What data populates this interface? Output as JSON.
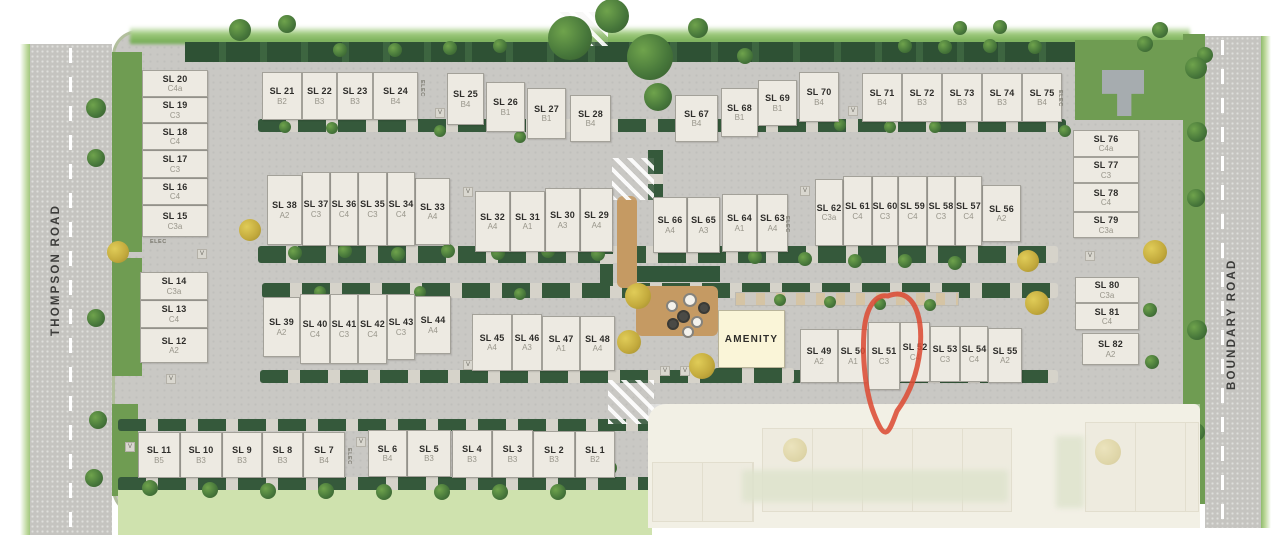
{
  "meta": {
    "description": "Residential strata site plan, 82 lots, amenity building, lot SL 51 circled in red"
  },
  "roads": {
    "left_label": "THOMPSON ROAD",
    "right_label": "BOUNDARY ROAD"
  },
  "amenity": {
    "label": "AMENITY"
  },
  "highlight": {
    "lot": "SL 51",
    "color": "#dc4c35"
  },
  "markers": {
    "visitor_label": "V",
    "elec_label": "ELEC"
  },
  "colors": {
    "lot_fill": "#edeae2",
    "road": "#c6c5c1",
    "hedge": "#31563a",
    "lawn": "#6f9c52",
    "amenity_fill": "#faf5d8",
    "annotation_red": "#dc4c35",
    "sand": "#c59a63"
  },
  "lots": [
    {
      "id": "SL 1",
      "code": "B2",
      "x": 575,
      "y": 431,
      "w": 40,
      "h": 47
    },
    {
      "id": "SL 2",
      "code": "B3",
      "x": 533,
      "y": 431,
      "w": 42,
      "h": 47
    },
    {
      "id": "SL 3",
      "code": "B3",
      "x": 492,
      "y": 430,
      "w": 41,
      "h": 48
    },
    {
      "id": "SL 4",
      "code": "B3",
      "x": 452,
      "y": 430,
      "w": 40,
      "h": 48
    },
    {
      "id": "SL 5",
      "code": "B3",
      "x": 407,
      "y": 430,
      "w": 44,
      "h": 47
    },
    {
      "id": "SL 6",
      "code": "B4",
      "x": 368,
      "y": 430,
      "w": 39,
      "h": 47
    },
    {
      "id": "SL 7",
      "code": "B4",
      "x": 303,
      "y": 432,
      "w": 42,
      "h": 46
    },
    {
      "id": "SL 8",
      "code": "B3",
      "x": 262,
      "y": 432,
      "w": 41,
      "h": 46
    },
    {
      "id": "SL 9",
      "code": "B3",
      "x": 222,
      "y": 432,
      "w": 40,
      "h": 46
    },
    {
      "id": "SL 10",
      "code": "B3",
      "x": 180,
      "y": 432,
      "w": 42,
      "h": 46
    },
    {
      "id": "SL 11",
      "code": "B5",
      "x": 138,
      "y": 432,
      "w": 42,
      "h": 46
    },
    {
      "id": "SL 12",
      "code": "A2",
      "x": 140,
      "y": 328,
      "w": 68,
      "h": 35
    },
    {
      "id": "SL 13",
      "code": "C4",
      "x": 140,
      "y": 300,
      "w": 68,
      "h": 28
    },
    {
      "id": "SL 14",
      "code": "C3a",
      "x": 140,
      "y": 272,
      "w": 68,
      "h": 28
    },
    {
      "id": "SL 15",
      "code": "C3a",
      "x": 142,
      "y": 205,
      "w": 66,
      "h": 32
    },
    {
      "id": "SL 16",
      "code": "C4",
      "x": 142,
      "y": 178,
      "w": 66,
      "h": 27
    },
    {
      "id": "SL 17",
      "code": "C3",
      "x": 142,
      "y": 150,
      "w": 66,
      "h": 28
    },
    {
      "id": "SL 18",
      "code": "C4",
      "x": 142,
      "y": 123,
      "w": 66,
      "h": 27
    },
    {
      "id": "SL 19",
      "code": "C3",
      "x": 142,
      "y": 97,
      "w": 66,
      "h": 26
    },
    {
      "id": "SL 20",
      "code": "C4a",
      "x": 142,
      "y": 70,
      "w": 66,
      "h": 27
    },
    {
      "id": "SL 21",
      "code": "B2",
      "x": 262,
      "y": 72,
      "w": 40,
      "h": 48
    },
    {
      "id": "SL 22",
      "code": "B3",
      "x": 302,
      "y": 72,
      "w": 35,
      "h": 48
    },
    {
      "id": "SL 23",
      "code": "B3",
      "x": 337,
      "y": 72,
      "w": 36,
      "h": 48
    },
    {
      "id": "SL 24",
      "code": "B4",
      "x": 373,
      "y": 72,
      "w": 45,
      "h": 48
    },
    {
      "id": "SL 25",
      "code": "B4",
      "x": 447,
      "y": 73,
      "w": 37,
      "h": 52
    },
    {
      "id": "SL 26",
      "code": "B1",
      "x": 486,
      "y": 82,
      "w": 39,
      "h": 50
    },
    {
      "id": "SL 27",
      "code": "B1",
      "x": 527,
      "y": 88,
      "w": 39,
      "h": 51
    },
    {
      "id": "SL 28",
      "code": "B4",
      "x": 570,
      "y": 95,
      "w": 41,
      "h": 47
    },
    {
      "id": "SL 29",
      "code": "A4",
      "x": 580,
      "y": 188,
      "w": 33,
      "h": 64
    },
    {
      "id": "SL 30",
      "code": "A3",
      "x": 545,
      "y": 188,
      "w": 35,
      "h": 64
    },
    {
      "id": "SL 31",
      "code": "A1",
      "x": 510,
      "y": 191,
      "w": 35,
      "h": 61
    },
    {
      "id": "SL 32",
      "code": "A4",
      "x": 475,
      "y": 191,
      "w": 35,
      "h": 61
    },
    {
      "id": "SL 33",
      "code": "A4",
      "x": 415,
      "y": 178,
      "w": 35,
      "h": 67
    },
    {
      "id": "SL 34",
      "code": "C4",
      "x": 387,
      "y": 172,
      "w": 28,
      "h": 74
    },
    {
      "id": "SL 35",
      "code": "C3",
      "x": 358,
      "y": 172,
      "w": 29,
      "h": 74
    },
    {
      "id": "SL 36",
      "code": "C4",
      "x": 330,
      "y": 172,
      "w": 28,
      "h": 74
    },
    {
      "id": "SL 37",
      "code": "C3",
      "x": 302,
      "y": 172,
      "w": 28,
      "h": 74
    },
    {
      "id": "SL 38",
      "code": "A2",
      "x": 267,
      "y": 175,
      "w": 35,
      "h": 70
    },
    {
      "id": "SL 39",
      "code": "A2",
      "x": 263,
      "y": 297,
      "w": 37,
      "h": 60
    },
    {
      "id": "SL 40",
      "code": "C4",
      "x": 300,
      "y": 294,
      "w": 30,
      "h": 70
    },
    {
      "id": "SL 41",
      "code": "C3",
      "x": 330,
      "y": 294,
      "w": 28,
      "h": 70
    },
    {
      "id": "SL 42",
      "code": "C4",
      "x": 358,
      "y": 294,
      "w": 29,
      "h": 70
    },
    {
      "id": "SL 43",
      "code": "C3",
      "x": 387,
      "y": 294,
      "w": 28,
      "h": 66
    },
    {
      "id": "SL 44",
      "code": "A4",
      "x": 415,
      "y": 296,
      "w": 36,
      "h": 58
    },
    {
      "id": "SL 45",
      "code": "A4",
      "x": 472,
      "y": 314,
      "w": 40,
      "h": 57
    },
    {
      "id": "SL 46",
      "code": "A3",
      "x": 512,
      "y": 314,
      "w": 30,
      "h": 57
    },
    {
      "id": "SL 47",
      "code": "A1",
      "x": 542,
      "y": 316,
      "w": 38,
      "h": 55
    },
    {
      "id": "SL 48",
      "code": "A4",
      "x": 580,
      "y": 316,
      "w": 35,
      "h": 55
    },
    {
      "id": "SL 49",
      "code": "A2",
      "x": 800,
      "y": 329,
      "w": 38,
      "h": 54
    },
    {
      "id": "SL 50",
      "code": "A1",
      "x": 838,
      "y": 329,
      "w": 30,
      "h": 54
    },
    {
      "id": "SL 51",
      "code": "C3",
      "x": 868,
      "y": 322,
      "w": 32,
      "h": 68
    },
    {
      "id": "SL 52",
      "code": "C4",
      "x": 900,
      "y": 322,
      "w": 30,
      "h": 60
    },
    {
      "id": "SL 53",
      "code": "C3",
      "x": 930,
      "y": 326,
      "w": 30,
      "h": 56
    },
    {
      "id": "SL 54",
      "code": "C4",
      "x": 960,
      "y": 326,
      "w": 28,
      "h": 56
    },
    {
      "id": "SL 55",
      "code": "A2",
      "x": 988,
      "y": 328,
      "w": 34,
      "h": 55
    },
    {
      "id": "SL 56",
      "code": "A2",
      "x": 982,
      "y": 185,
      "w": 39,
      "h": 57
    },
    {
      "id": "SL 57",
      "code": "C4",
      "x": 955,
      "y": 176,
      "w": 27,
      "h": 70
    },
    {
      "id": "SL 58",
      "code": "C3",
      "x": 927,
      "y": 176,
      "w": 28,
      "h": 70
    },
    {
      "id": "SL 59",
      "code": "C4",
      "x": 898,
      "y": 176,
      "w": 29,
      "h": 70
    },
    {
      "id": "SL 60",
      "code": "C3",
      "x": 872,
      "y": 176,
      "w": 26,
      "h": 70
    },
    {
      "id": "SL 61",
      "code": "C4",
      "x": 843,
      "y": 176,
      "w": 29,
      "h": 70
    },
    {
      "id": "SL 62",
      "code": "C3a",
      "x": 815,
      "y": 179,
      "w": 28,
      "h": 67
    },
    {
      "id": "SL 63",
      "code": "A4",
      "x": 757,
      "y": 194,
      "w": 31,
      "h": 58
    },
    {
      "id": "SL 64",
      "code": "A1",
      "x": 722,
      "y": 194,
      "w": 35,
      "h": 58
    },
    {
      "id": "SL 65",
      "code": "A3",
      "x": 687,
      "y": 197,
      "w": 33,
      "h": 56
    },
    {
      "id": "SL 66",
      "code": "A4",
      "x": 653,
      "y": 197,
      "w": 34,
      "h": 56
    },
    {
      "id": "SL 67",
      "code": "B4",
      "x": 675,
      "y": 95,
      "w": 43,
      "h": 47
    },
    {
      "id": "SL 68",
      "code": "B1",
      "x": 721,
      "y": 88,
      "w": 37,
      "h": 49
    },
    {
      "id": "SL 69",
      "code": "B1",
      "x": 758,
      "y": 80,
      "w": 39,
      "h": 46
    },
    {
      "id": "SL 70",
      "code": "B4",
      "x": 799,
      "y": 72,
      "w": 40,
      "h": 50
    },
    {
      "id": "SL 71",
      "code": "B4",
      "x": 862,
      "y": 73,
      "w": 40,
      "h": 49
    },
    {
      "id": "SL 72",
      "code": "B3",
      "x": 902,
      "y": 73,
      "w": 40,
      "h": 49
    },
    {
      "id": "SL 73",
      "code": "B3",
      "x": 942,
      "y": 73,
      "w": 40,
      "h": 49
    },
    {
      "id": "SL 74",
      "code": "B3",
      "x": 982,
      "y": 73,
      "w": 40,
      "h": 49
    },
    {
      "id": "SL 75",
      "code": "B4",
      "x": 1022,
      "y": 73,
      "w": 40,
      "h": 49
    },
    {
      "id": "SL 76",
      "code": "C4a",
      "x": 1073,
      "y": 130,
      "w": 66,
      "h": 27
    },
    {
      "id": "SL 77",
      "code": "C3",
      "x": 1073,
      "y": 157,
      "w": 66,
      "h": 26
    },
    {
      "id": "SL 78",
      "code": "C4",
      "x": 1073,
      "y": 183,
      "w": 66,
      "h": 29
    },
    {
      "id": "SL 79",
      "code": "C3a",
      "x": 1073,
      "y": 212,
      "w": 66,
      "h": 26
    },
    {
      "id": "SL 80",
      "code": "C3a",
      "x": 1075,
      "y": 277,
      "w": 64,
      "h": 26
    },
    {
      "id": "SL 81",
      "code": "C4",
      "x": 1075,
      "y": 303,
      "w": 64,
      "h": 27
    },
    {
      "id": "SL 82",
      "code": "A2",
      "x": 1082,
      "y": 333,
      "w": 57,
      "h": 32
    }
  ],
  "amenity_rect": {
    "x": 718,
    "y": 310,
    "w": 67,
    "h": 58
  },
  "landscape_rects": [
    {
      "c": "fringe",
      "n": "top-green-fringe",
      "x": 130,
      "y": 26,
      "w": 1060,
      "h": 18
    },
    {
      "c": "hedge-band",
      "n": "top-hedge-band",
      "x": 185,
      "y": 42,
      "w": 895,
      "h": 20
    },
    {
      "c": "lawn",
      "n": "clubhouse-lawn",
      "x": 1075,
      "y": 40,
      "w": 122,
      "h": 80
    },
    {
      "c": "lawn",
      "n": "boundary-median-lawn",
      "x": 1183,
      "y": 34,
      "w": 22,
      "h": 470
    },
    {
      "c": "lawn",
      "n": "left-lawn",
      "x": 112,
      "y": 52,
      "w": 30,
      "h": 200
    },
    {
      "c": "lawn",
      "n": "left-lawn",
      "x": 112,
      "y": 258,
      "w": 30,
      "h": 118
    },
    {
      "c": "lawn",
      "n": "left-lawn",
      "x": 112,
      "y": 404,
      "w": 26,
      "h": 92
    },
    {
      "c": "hedge",
      "n": "hedge-strip",
      "x": 258,
      "y": 119,
      "w": 808,
      "h": 13
    },
    {
      "c": "hedge",
      "n": "hedge-strip",
      "x": 258,
      "y": 246,
      "w": 800,
      "h": 17
    },
    {
      "c": "hedge",
      "n": "hedge-strip",
      "x": 262,
      "y": 283,
      "w": 796,
      "h": 15
    },
    {
      "c": "hedge",
      "n": "hedge-strip",
      "x": 260,
      "y": 370,
      "w": 798,
      "h": 13
    },
    {
      "c": "hedge",
      "n": "hedge-strip",
      "x": 118,
      "y": 419,
      "w": 532,
      "h": 12
    },
    {
      "c": "hedge",
      "n": "hedge-strip",
      "x": 118,
      "y": 477,
      "w": 538,
      "h": 14
    },
    {
      "c": "hedge-v",
      "n": "hedge-strip-vertical",
      "x": 600,
      "y": 196,
      "w": 13,
      "h": 90
    },
    {
      "c": "hedge-v",
      "n": "hedge-strip-vertical",
      "x": 648,
      "y": 150,
      "w": 15,
      "h": 50
    },
    {
      "c": "hedge-solid",
      "n": "playground-hedge",
      "x": 636,
      "y": 266,
      "w": 84,
      "h": 16
    },
    {
      "c": "hedge",
      "n": "hedge-strip",
      "x": 714,
      "y": 368,
      "w": 80,
      "h": 15
    },
    {
      "c": "lawn-light",
      "n": "bottom-grass-band",
      "x": 118,
      "y": 490,
      "w": 534,
      "h": 45
    },
    {
      "c": "sand",
      "n": "sand-path",
      "x": 617,
      "y": 196,
      "w": 20,
      "h": 92
    },
    {
      "c": "sand",
      "n": "playground-sand-pad",
      "x": 636,
      "y": 286,
      "w": 82,
      "h": 50
    },
    {
      "c": "xwalk",
      "n": "crosswalk",
      "x": 560,
      "y": 12,
      "w": 48,
      "h": 34
    },
    {
      "c": "xwalk",
      "n": "crosswalk",
      "x": 612,
      "y": 158,
      "w": 42,
      "h": 42
    },
    {
      "c": "xwalk",
      "n": "crosswalk",
      "x": 608,
      "y": 380,
      "w": 46,
      "h": 44
    },
    {
      "c": "stalls",
      "n": "parking-stalls",
      "x": 735,
      "y": 292,
      "w": 222,
      "h": 12
    },
    {
      "c": "clubhouse",
      "n": "clubhouse-building",
      "x": 1102,
      "y": 70,
      "w": 42,
      "h": 46
    },
    {
      "c": "fbase",
      "n": "faded-future-phase",
      "x": 648,
      "y": 404,
      "w": 552,
      "h": 124
    },
    {
      "c": "fbuild",
      "n": "faded-building",
      "x": 762,
      "y": 428,
      "w": 248,
      "h": 82
    },
    {
      "c": "fbuild",
      "n": "faded-building",
      "x": 1085,
      "y": 422,
      "w": 112,
      "h": 88
    },
    {
      "c": "fbuild",
      "n": "faded-building",
      "x": 652,
      "y": 462,
      "w": 100,
      "h": 58
    },
    {
      "c": "ffuzz",
      "n": "faded-greenery",
      "x": 742,
      "y": 470,
      "w": 266,
      "h": 32
    },
    {
      "c": "ffuzz",
      "n": "faded-greenery",
      "x": 1056,
      "y": 436,
      "w": 28,
      "h": 72
    },
    {
      "c": "ftree",
      "n": "faded-tree-icon",
      "x": 783,
      "y": 438,
      "w": 24,
      "h": 24
    },
    {
      "c": "ftree",
      "n": "faded-tree-icon",
      "x": 1095,
      "y": 439,
      "w": 26,
      "h": 26
    },
    {
      "c": "foverlay",
      "n": "fade-overlay",
      "x": 648,
      "y": 404,
      "w": 552,
      "h": 124
    }
  ],
  "trees_green_big": [
    [
      570,
      38,
      22
    ],
    [
      612,
      16,
      17
    ],
    [
      650,
      57,
      23
    ],
    [
      658,
      97,
      14
    ]
  ],
  "trees_green": [
    [
      240,
      30,
      11
    ],
    [
      287,
      24,
      9
    ],
    [
      340,
      50,
      7
    ],
    [
      395,
      50,
      7
    ],
    [
      450,
      48,
      7
    ],
    [
      500,
      46,
      7
    ],
    [
      698,
      28,
      10
    ],
    [
      745,
      56,
      8
    ],
    [
      905,
      46,
      7
    ],
    [
      945,
      47,
      7
    ],
    [
      990,
      46,
      7
    ],
    [
      1035,
      47,
      7
    ],
    [
      960,
      28,
      7
    ],
    [
      1000,
      27,
      7
    ],
    [
      1145,
      44,
      8
    ],
    [
      1205,
      55,
      8
    ],
    [
      1160,
      30,
      8
    ],
    [
      96,
      108,
      10
    ],
    [
      96,
      158,
      9
    ],
    [
      96,
      318,
      9
    ],
    [
      98,
      420,
      9
    ],
    [
      94,
      478,
      9
    ],
    [
      1196,
      68,
      11
    ],
    [
      1197,
      132,
      10
    ],
    [
      1196,
      198,
      9
    ],
    [
      1197,
      330,
      10
    ],
    [
      1196,
      432,
      9
    ],
    [
      285,
      127,
      6
    ],
    [
      332,
      128,
      6
    ],
    [
      440,
      131,
      6
    ],
    [
      520,
      137,
      6
    ],
    [
      840,
      125,
      6
    ],
    [
      890,
      127,
      6
    ],
    [
      935,
      127,
      6
    ],
    [
      1065,
      131,
      6
    ],
    [
      295,
      253,
      7
    ],
    [
      345,
      251,
      7
    ],
    [
      398,
      254,
      7
    ],
    [
      448,
      251,
      7
    ],
    [
      498,
      253,
      7
    ],
    [
      548,
      251,
      7
    ],
    [
      598,
      254,
      7
    ],
    [
      755,
      257,
      7
    ],
    [
      805,
      259,
      7
    ],
    [
      855,
      261,
      7
    ],
    [
      905,
      261,
      7
    ],
    [
      955,
      263,
      7
    ],
    [
      320,
      292,
      6
    ],
    [
      420,
      292,
      6
    ],
    [
      520,
      294,
      6
    ],
    [
      780,
      300,
      6
    ],
    [
      830,
      302,
      6
    ],
    [
      880,
      304,
      6
    ],
    [
      930,
      305,
      6
    ],
    [
      150,
      488,
      8
    ],
    [
      210,
      490,
      8
    ],
    [
      268,
      491,
      8
    ],
    [
      326,
      491,
      8
    ],
    [
      384,
      492,
      8
    ],
    [
      442,
      492,
      8
    ],
    [
      500,
      492,
      8
    ],
    [
      558,
      492,
      8
    ],
    [
      610,
      468,
      7
    ],
    [
      1150,
      310,
      7
    ],
    [
      1152,
      362,
      7
    ]
  ],
  "trees_yellow": [
    [
      118,
      252,
      11
    ],
    [
      250,
      230,
      11
    ],
    [
      638,
      296,
      13
    ],
    [
      629,
      342,
      12
    ],
    [
      702,
      366,
      13
    ],
    [
      1028,
      261,
      11
    ],
    [
      1037,
      303,
      12
    ],
    [
      1155,
      252,
      12
    ]
  ],
  "playground_equipment": [
    [
      688,
      298,
      10,
      0
    ],
    [
      702,
      306,
      8,
      1
    ],
    [
      670,
      304,
      8,
      0
    ],
    [
      681,
      314,
      9,
      1
    ],
    [
      695,
      320,
      8,
      0
    ],
    [
      671,
      322,
      8,
      1
    ],
    [
      686,
      330,
      8,
      0
    ]
  ],
  "v_markers": [
    [
      435,
      108
    ],
    [
      848,
      106
    ],
    [
      197,
      249
    ],
    [
      463,
      187
    ],
    [
      800,
      186
    ],
    [
      463,
      360
    ],
    [
      660,
      366
    ],
    [
      680,
      366
    ],
    [
      166,
      374
    ],
    [
      125,
      442
    ],
    [
      356,
      437
    ],
    [
      1085,
      251
    ]
  ],
  "elec_markers": [
    {
      "x": 150,
      "y": 239,
      "vertical": false
    },
    {
      "x": 352,
      "y": 448,
      "vertical": true
    },
    {
      "x": 790,
      "y": 216,
      "vertical": true
    },
    {
      "x": 1063,
      "y": 90,
      "vertical": true
    },
    {
      "x": 425,
      "y": 80,
      "vertical": true
    }
  ]
}
